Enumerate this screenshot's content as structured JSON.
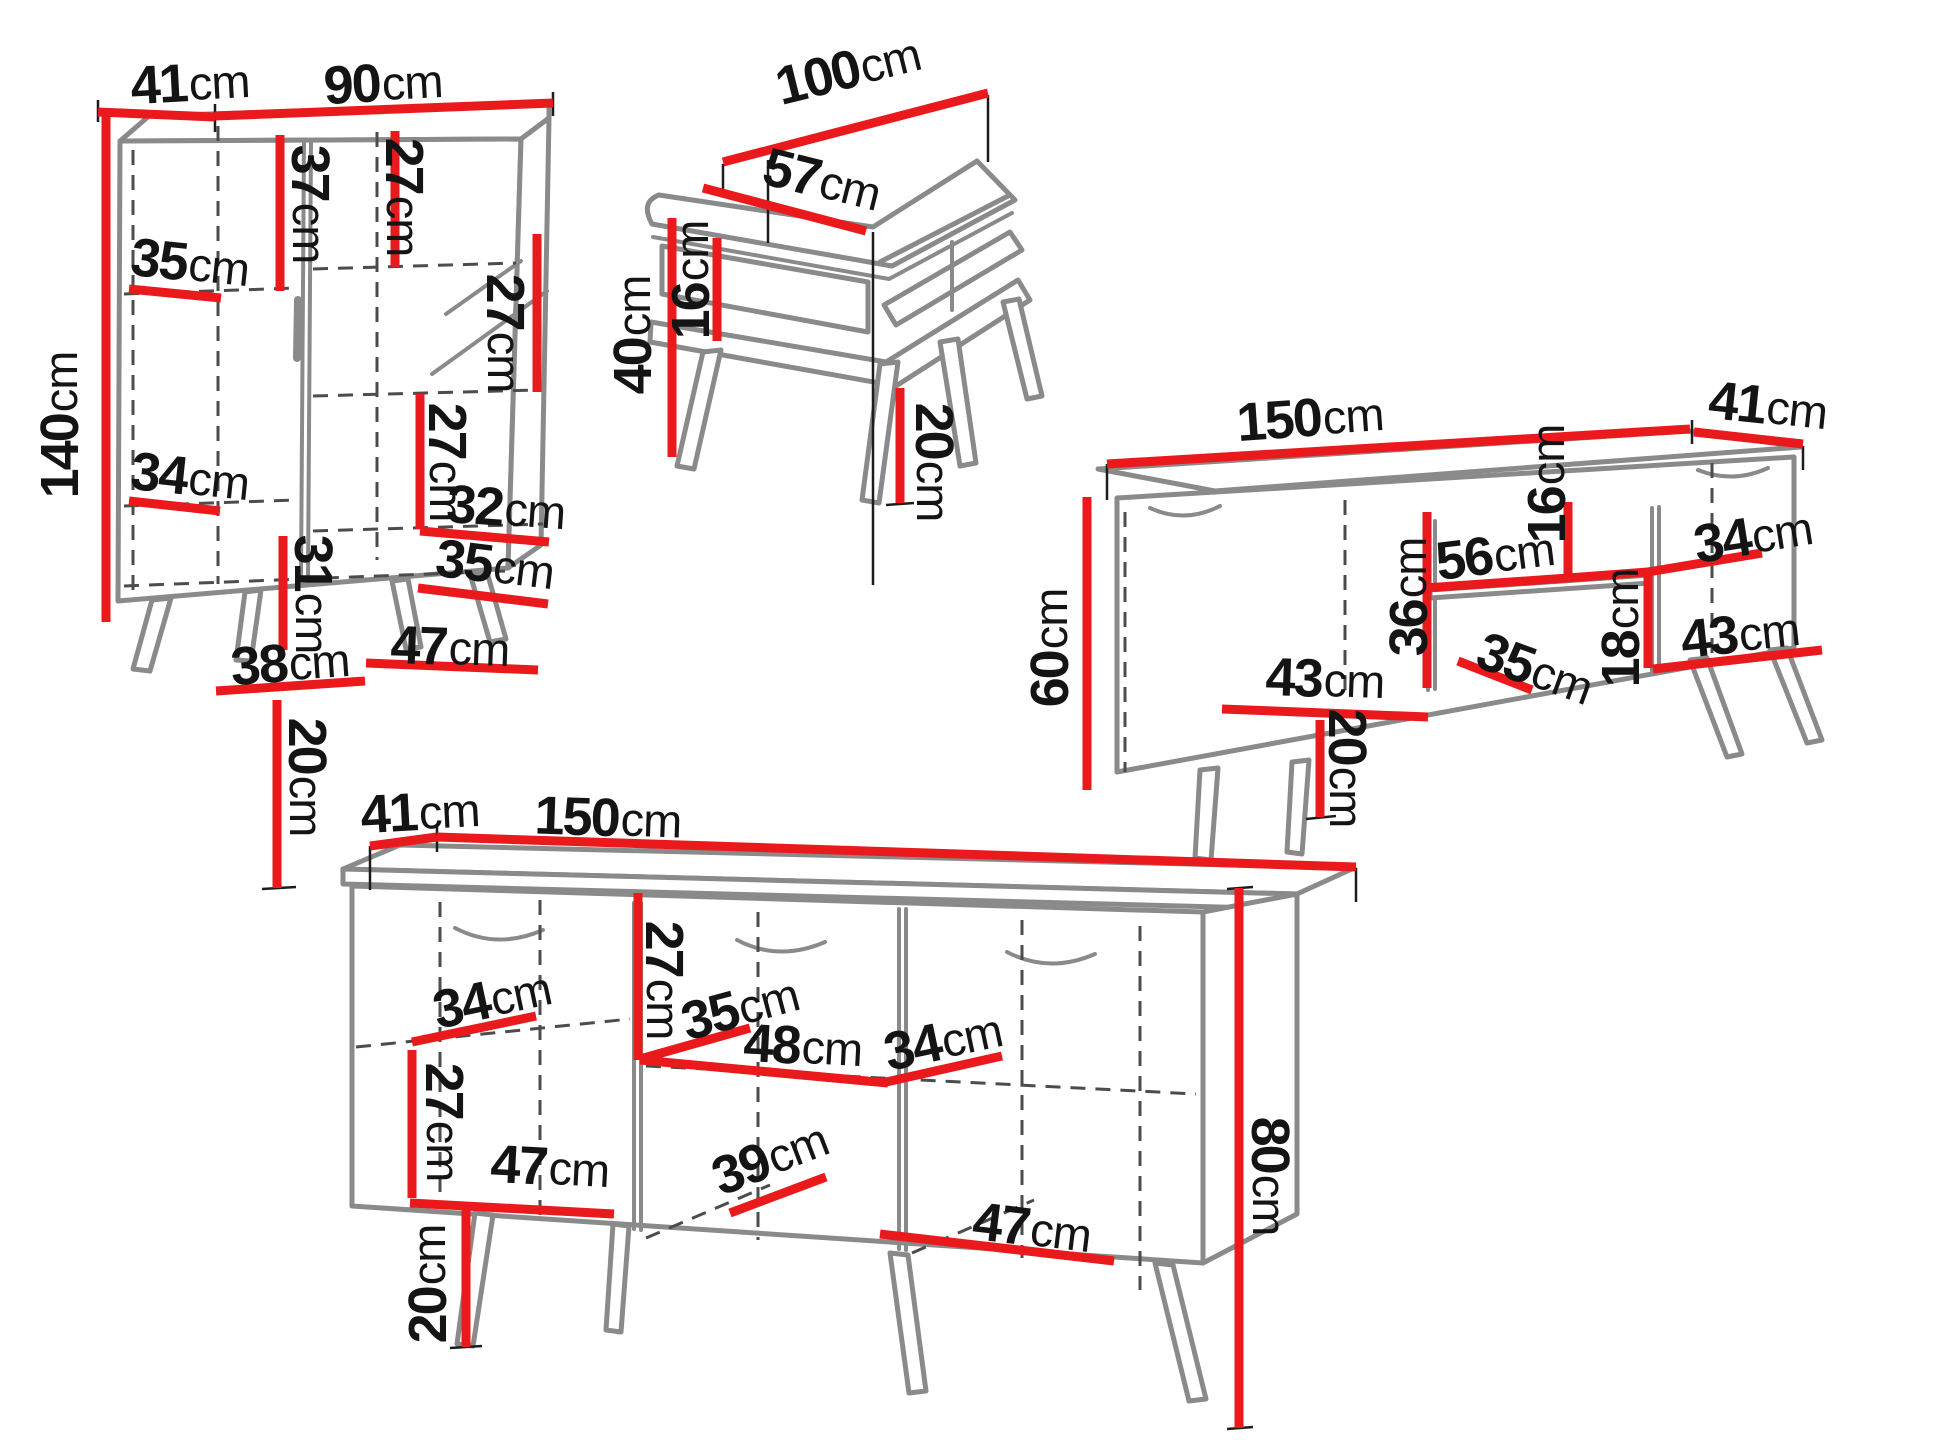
{
  "unit": "cm",
  "colors": {
    "dimension_line": "#e9191c",
    "furniture_line": "#8a8a8a",
    "dashed_line": "#4c4c4c",
    "label_text": "#141414",
    "background": "#ffffff"
  },
  "cabinet": {
    "labels": [
      {
        "v": "41",
        "u": "cm"
      },
      {
        "v": "90",
        "u": "cm"
      },
      {
        "v": "140",
        "u": "cm"
      },
      {
        "v": "37",
        "u": "cm"
      },
      {
        "v": "27",
        "u": "cm"
      },
      {
        "v": "35",
        "u": "cm"
      },
      {
        "v": "27",
        "u": "cm"
      },
      {
        "v": "27",
        "u": "cm"
      },
      {
        "v": "34",
        "u": "cm"
      },
      {
        "v": "31",
        "u": "cm"
      },
      {
        "v": "32",
        "u": "cm"
      },
      {
        "v": "35",
        "u": "cm"
      },
      {
        "v": "38",
        "u": "cm"
      },
      {
        "v": "47",
        "u": "cm"
      },
      {
        "v": "20",
        "u": "cm"
      }
    ]
  },
  "coffee_table": {
    "labels": [
      {
        "v": "100",
        "u": "cm"
      },
      {
        "v": "57",
        "u": "cm"
      },
      {
        "v": "40",
        "u": "cm"
      },
      {
        "v": "16",
        "u": "cm"
      },
      {
        "v": "20",
        "u": "cm"
      }
    ]
  },
  "tv_stand": {
    "labels": [
      {
        "v": "150",
        "u": "cm"
      },
      {
        "v": "41",
        "u": "cm"
      },
      {
        "v": "60",
        "u": "cm"
      },
      {
        "v": "16",
        "u": "cm"
      },
      {
        "v": "34",
        "u": "cm"
      },
      {
        "v": "56",
        "u": "cm"
      },
      {
        "v": "36",
        "u": "cm"
      },
      {
        "v": "18",
        "u": "cm"
      },
      {
        "v": "35",
        "u": "cm"
      },
      {
        "v": "43",
        "u": "cm"
      },
      {
        "v": "43",
        "u": "cm"
      },
      {
        "v": "20",
        "u": "cm"
      }
    ]
  },
  "sideboard": {
    "labels": [
      {
        "v": "41",
        "u": "cm"
      },
      {
        "v": "150",
        "u": "cm"
      },
      {
        "v": "27",
        "u": "cm"
      },
      {
        "v": "34",
        "u": "cm"
      },
      {
        "v": "35",
        "u": "cm"
      },
      {
        "v": "48",
        "u": "cm"
      },
      {
        "v": "34",
        "u": "cm"
      },
      {
        "v": "27",
        "u": "cm"
      },
      {
        "v": "47",
        "u": "cm"
      },
      {
        "v": "39",
        "u": "cm"
      },
      {
        "v": "47",
        "u": "cm"
      },
      {
        "v": "80",
        "u": "cm"
      },
      {
        "v": "20",
        "u": "cm"
      }
    ]
  }
}
